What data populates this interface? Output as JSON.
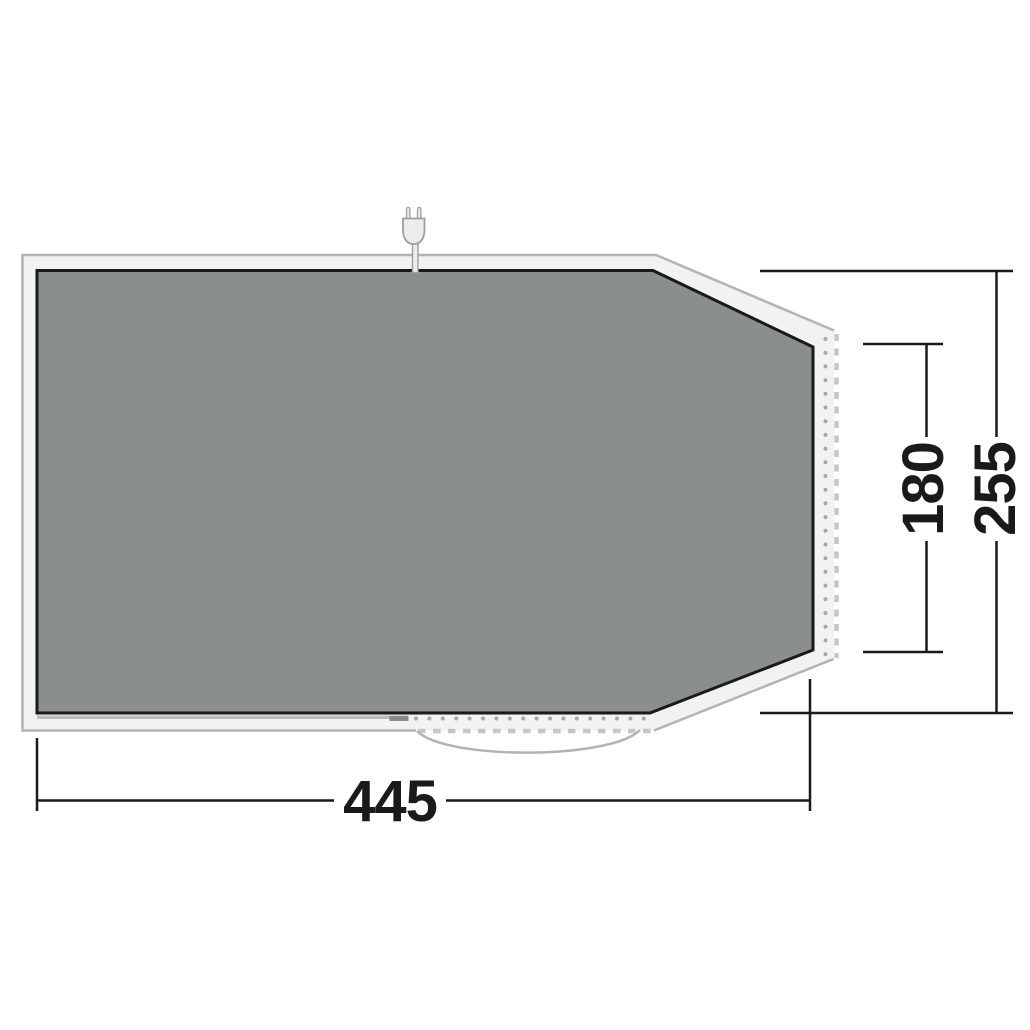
{
  "diagram": {
    "dimension_labels": {
      "bottom_width": "445",
      "right_inner_depth": "180",
      "right_total_depth": "255"
    },
    "icons": {
      "plug": "power-plug-icon"
    },
    "colors": {
      "floor_fill": "#8a8e8c",
      "floor_border": "#1a1a1a",
      "groundsheet_fill": "#f2f2f2",
      "groundsheet_outline": "#b3b3b3",
      "attachment_dot": "#a8a8a8",
      "edge_dash": "#c6c6c6",
      "dimension_line": "#1a1a1a",
      "background": "#ffffff"
    }
  }
}
